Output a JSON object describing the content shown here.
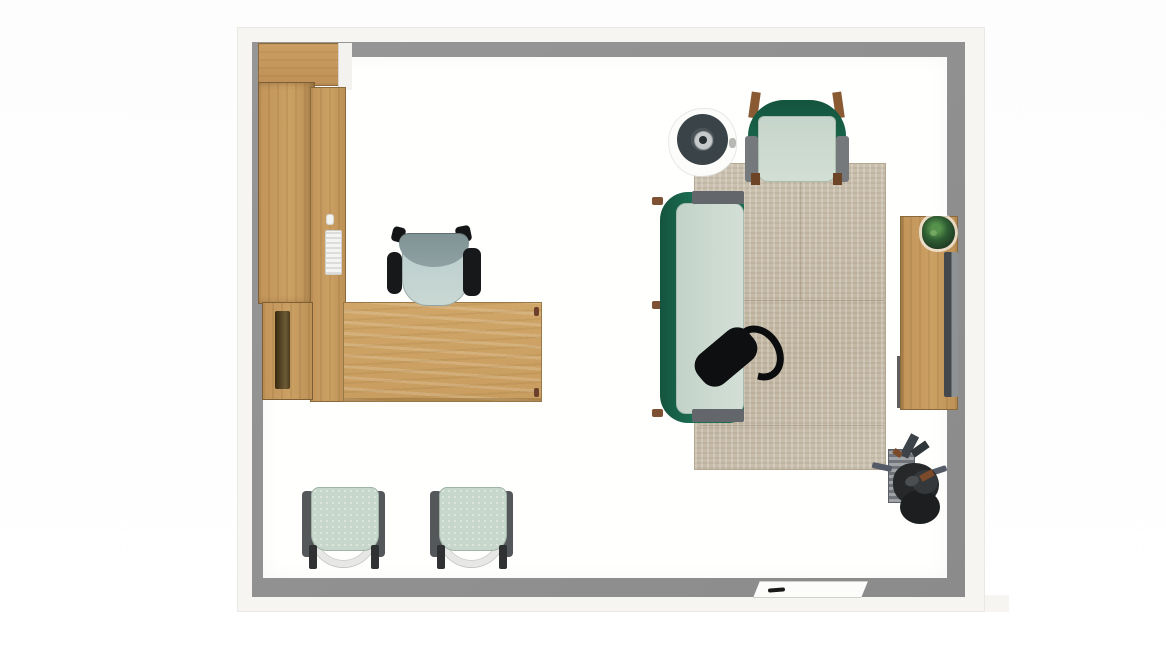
{
  "scene": {
    "type": "top-down office floor plan render",
    "room": {
      "wall_fill_color": "#8f8f8f",
      "wall_trim_color": "#f6f5f2",
      "floor_color": "#fffffe",
      "background_color": "#ffffff"
    },
    "palette": {
      "wood": "#c89d5f",
      "wood_dark_edge": "#7e5f35",
      "sage_upholstery": "#c8d7cc",
      "green_upholstery": "#1b6950",
      "gray_armrest": "#54585a",
      "rug_beige": "#c8bead",
      "black_furniture": "#0e0f10",
      "screen_gray": "#43484c",
      "plant_green": "#2f5d33"
    },
    "furniture": [
      {
        "name": "wardrobe-cabinet",
        "area": "top-left along left wall",
        "color": "#c59758"
      },
      {
        "name": "l-shaped-desk",
        "area": "left-center",
        "color": "#cda365"
      },
      {
        "name": "desk-task-chair",
        "area": "at desk, facing down",
        "seat_color": "#c9d8d3",
        "back_color": "#8fa1a2",
        "arm_color": "#17181a"
      },
      {
        "name": "guest-chair-1",
        "area": "bottom-left",
        "seat_color": "#c8d7cc",
        "arm_color": "#54585a",
        "frame_color": "#e7e8e5"
      },
      {
        "name": "guest-chair-2",
        "area": "bottom-left",
        "seat_color": "#c8d7cc",
        "arm_color": "#54585a",
        "frame_color": "#e7e8e5"
      },
      {
        "name": "round-side-table",
        "area": "upper-middle",
        "top_color": "#3a4347",
        "hub_color": "#c7cacb"
      },
      {
        "name": "green-armchair",
        "area": "top of rug",
        "frame_color": "#1b6950",
        "cushion_color": "#d2ded4",
        "leg_color": "#8a5a33"
      },
      {
        "name": "green-sofa",
        "area": "left edge of rug",
        "frame_color": "#1b6950",
        "cushion_color": "#d3dfd6",
        "cap_color": "#63666a"
      },
      {
        "name": "black-lounge-chair",
        "area": "on sofa/rug, rotated",
        "color": "#0e0f10"
      },
      {
        "name": "area-rug",
        "area": "right half of room",
        "color": "#c8bead"
      },
      {
        "name": "media-console",
        "area": "right wall",
        "color": "#c79e63"
      },
      {
        "name": "wall-screen",
        "area": "right wall on console",
        "color": "#43484c"
      },
      {
        "name": "potted-plant",
        "area": "on console",
        "color": "#2f5d33"
      },
      {
        "name": "task-chair-station",
        "area": "bottom-right corner",
        "color": "#26282a"
      },
      {
        "name": "whiteboard",
        "area": "bottom wall",
        "color": "#fcfcfa",
        "marker_color": "#1a1a1a"
      }
    ]
  }
}
